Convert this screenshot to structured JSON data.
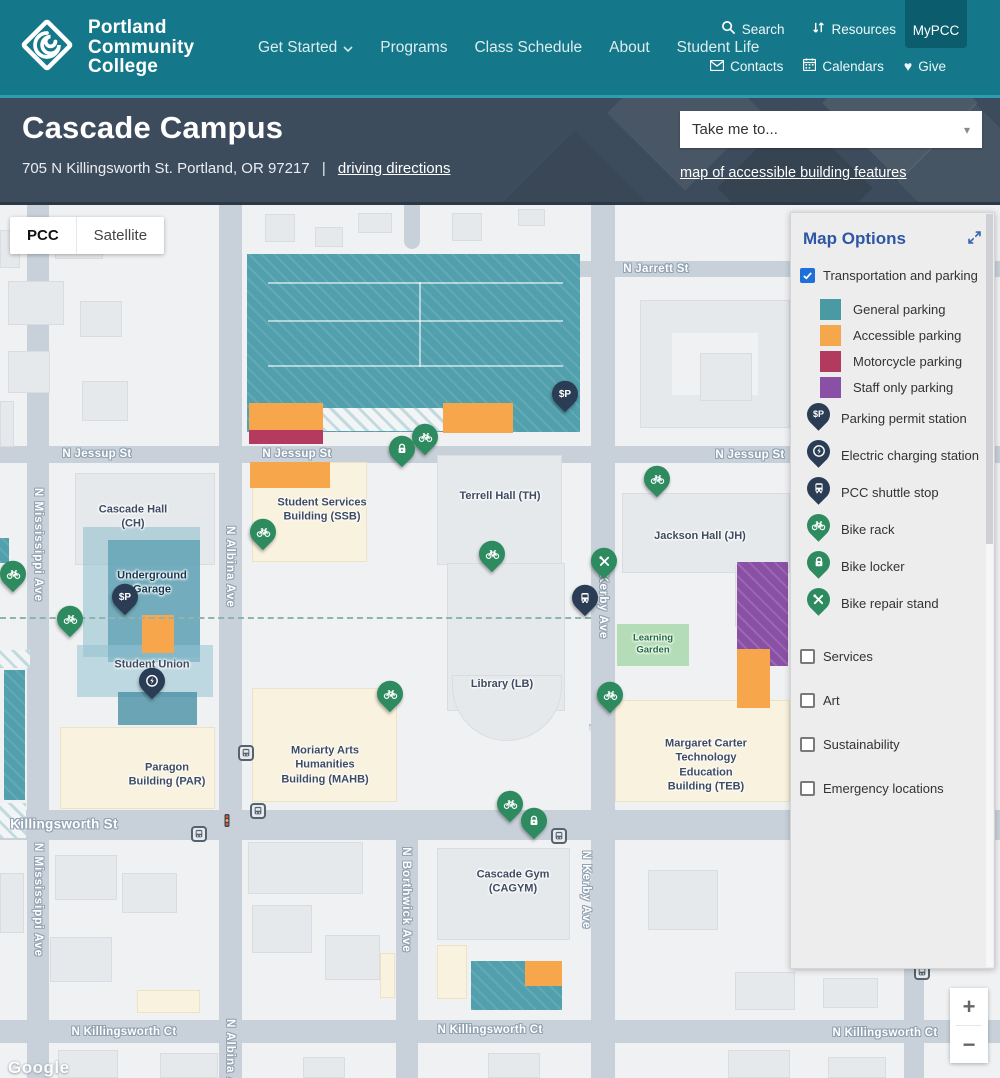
{
  "colors": {
    "header_teal": "#15788A",
    "header_teal_dark": "#0B5C6C",
    "subheader_dark": "#3D4C5C",
    "accent_blue": "#2D57A5",
    "checkbox_blue": "#1E6FD9",
    "pin_navy": "#2B3C55",
    "pin_green": "#2E8B5F",
    "street_gray": "#C8D1DA",
    "parking_teal": "#52A0AD",
    "parking_orange": "#F7A64B",
    "parking_magenta": "#B43A60",
    "parking_purple": "#8A50A5"
  },
  "header": {
    "logo": "Portland\nCommunity\nCollege",
    "nav": [
      {
        "label": "Get Started",
        "dropdown": true
      },
      {
        "label": "Programs"
      },
      {
        "label": "Class Schedule"
      },
      {
        "label": "About"
      },
      {
        "label": "Student Life"
      }
    ],
    "utility_top": [
      {
        "icon": "search",
        "label": "Search"
      },
      {
        "icon": "resources",
        "label": "Resources"
      }
    ],
    "mypcc": "MyPCC",
    "utility_bottom": [
      {
        "icon": "mail",
        "label": "Contacts"
      },
      {
        "icon": "calendar",
        "label": "Calendars"
      },
      {
        "icon": "heart",
        "label": "Give"
      }
    ]
  },
  "subheader": {
    "title": "Cascade Campus",
    "address": "705 N Killingsworth St. Portland, OR 97217",
    "separator": "|",
    "directions_link": "driving directions",
    "dropdown_placeholder": "Take me to...",
    "accessible_link": "map of accessible building features"
  },
  "panel": {
    "title": "Map Options",
    "sections": [
      {
        "type": "checkbox",
        "checked": true,
        "label": "Transportation and parking"
      },
      {
        "type": "swatch",
        "first": true,
        "color": "#4A9AA4",
        "label": "General parking"
      },
      {
        "type": "swatch",
        "color": "#F5A74B",
        "label": "Accessible parking"
      },
      {
        "type": "swatch",
        "color": "#B23A5E",
        "label": "Motorcycle parking"
      },
      {
        "type": "swatch",
        "color": "#8A50A5",
        "label": "Staff only parking"
      },
      {
        "type": "pin",
        "pin": "navy",
        "icon": "permit",
        "label": "Parking permit station"
      },
      {
        "type": "pin",
        "pin": "navy",
        "icon": "ev",
        "label": "Electric charging station"
      },
      {
        "type": "pin",
        "pin": "navy",
        "icon": "bus",
        "label": "PCC shuttle stop"
      },
      {
        "type": "pin",
        "pin": "green",
        "icon": "bike",
        "label": "Bike rack"
      },
      {
        "type": "pin",
        "pin": "green",
        "icon": "lock",
        "label": "Bike locker"
      },
      {
        "type": "pin",
        "pin": "green",
        "icon": "tools",
        "label": "Bike repair stand"
      },
      {
        "type": "checkbox",
        "checked": false,
        "spaced": true,
        "label": "Services"
      },
      {
        "type": "checkbox",
        "checked": false,
        "spaced": true,
        "label": "Art"
      },
      {
        "type": "checkbox",
        "checked": false,
        "spaced": true,
        "label": "Sustainability"
      },
      {
        "type": "checkbox",
        "checked": false,
        "spaced": true,
        "label": "Emergency locations"
      }
    ]
  },
  "map": {
    "controls": {
      "map_type": [
        "PCC",
        "Satellite"
      ],
      "zoom_in": "+",
      "zoom_out": "−"
    },
    "attribution": "Google",
    "elements": [
      {
        "n": "street-n-mississippi-ave",
        "c": "st",
        "x": 27,
        "y": 0,
        "w": 22,
        "h": 873
      },
      {
        "n": "street-n-albina-ave",
        "c": "st",
        "x": 219,
        "y": 0,
        "w": 23,
        "h": 873
      },
      {
        "n": "street-n-kerby-ave",
        "c": "st",
        "x": 591,
        "y": 0,
        "w": 24,
        "h": 873
      },
      {
        "n": "street-n-borthwick-ave",
        "c": "st",
        "x": 396,
        "y": 635,
        "w": 22,
        "h": 238
      },
      {
        "n": "street-stub",
        "c": "st rnd",
        "x": 404,
        "y": 0,
        "w": 16,
        "h": 44
      },
      {
        "n": "street-right",
        "c": "st",
        "x": 904,
        "y": 755,
        "w": 20,
        "h": 118
      },
      {
        "n": "street-n-jarrett-st",
        "c": "st",
        "x": 578,
        "y": 56,
        "w": 422,
        "h": 16
      },
      {
        "n": "street-n-jessup-st",
        "c": "st",
        "x": 0,
        "y": 241,
        "w": 1000,
        "h": 17
      },
      {
        "n": "street-n-killingsworth-st",
        "c": "st",
        "x": 0,
        "y": 605,
        "w": 1000,
        "h": 30
      },
      {
        "n": "street-n-killingsworth-ct",
        "c": "st",
        "x": 0,
        "y": 815,
        "w": 1000,
        "h": 23
      },
      {
        "c": "bld",
        "x": 0,
        "y": 25,
        "w": 20,
        "h": 38
      },
      {
        "c": "bld",
        "x": 55,
        "y": 18,
        "w": 48,
        "h": 36
      },
      {
        "c": "bld",
        "x": 8,
        "y": 76,
        "w": 56,
        "h": 44
      },
      {
        "c": "bld",
        "x": 80,
        "y": 96,
        "w": 42,
        "h": 36
      },
      {
        "c": "bld",
        "x": 8,
        "y": 146,
        "w": 42,
        "h": 42
      },
      {
        "c": "bld",
        "x": 82,
        "y": 176,
        "w": 46,
        "h": 40
      },
      {
        "c": "bld",
        "x": 0,
        "y": 196,
        "w": 14,
        "h": 46
      },
      {
        "c": "bld",
        "x": 265,
        "y": 9,
        "w": 30,
        "h": 28
      },
      {
        "c": "bld",
        "x": 315,
        "y": 22,
        "w": 28,
        "h": 20
      },
      {
        "c": "bld",
        "x": 358,
        "y": 8,
        "w": 34,
        "h": 20
      },
      {
        "c": "bld",
        "x": 452,
        "y": 8,
        "w": 30,
        "h": 28
      },
      {
        "c": "bld",
        "x": 518,
        "y": 4,
        "w": 27,
        "h": 17
      },
      {
        "n": "building-north-complex",
        "c": "bld",
        "x": 640,
        "y": 95,
        "w": 150,
        "h": 128
      },
      {
        "c": "cutout",
        "x": 672,
        "y": 128,
        "w": 86,
        "h": 62
      },
      {
        "c": "bld",
        "x": 700,
        "y": 148,
        "w": 52,
        "h": 48
      },
      {
        "n": "building-cascade-hall",
        "c": "bld",
        "x": 75,
        "y": 268,
        "w": 140,
        "h": 92
      },
      {
        "n": "building-ssb",
        "c": "bld cream",
        "x": 252,
        "y": 257,
        "w": 115,
        "h": 100
      },
      {
        "n": "building-terrell-hall",
        "c": "bld",
        "x": 437,
        "y": 250,
        "w": 125,
        "h": 110
      },
      {
        "n": "building-jackson-hall",
        "c": "bld",
        "x": 622,
        "y": 288,
        "w": 168,
        "h": 80
      },
      {
        "c": "bld",
        "x": 735,
        "y": 360,
        "w": 53,
        "h": 62
      },
      {
        "n": "building-library",
        "c": "bld",
        "x": 447,
        "y": 358,
        "w": 118,
        "h": 148
      },
      {
        "c": "bld arc",
        "x": 452,
        "y": 470,
        "w": 110,
        "h": 66
      },
      {
        "n": "building-mahb",
        "c": "bld cream",
        "x": 252,
        "y": 483,
        "w": 145,
        "h": 114
      },
      {
        "n": "building-teb",
        "c": "bld cream",
        "x": 615,
        "y": 495,
        "w": 175,
        "h": 102
      },
      {
        "n": "building-paragon",
        "c": "bld cream",
        "x": 60,
        "y": 522,
        "w": 155,
        "h": 82
      },
      {
        "c": "bld",
        "x": 248,
        "y": 637,
        "w": 115,
        "h": 52
      },
      {
        "n": "building-cascade-gym",
        "c": "bld",
        "x": 437,
        "y": 643,
        "w": 133,
        "h": 92
      },
      {
        "c": "bld cream",
        "x": 437,
        "y": 740,
        "w": 30,
        "h": 54
      },
      {
        "c": "bld cream",
        "x": 380,
        "y": 748,
        "w": 15,
        "h": 45
      },
      {
        "c": "bld cream",
        "x": 137,
        "y": 785,
        "w": 63,
        "h": 23
      },
      {
        "c": "bld",
        "x": 648,
        "y": 665,
        "w": 70,
        "h": 60
      },
      {
        "c": "bld",
        "x": 735,
        "y": 767,
        "w": 60,
        "h": 38
      },
      {
        "c": "bld",
        "x": 823,
        "y": 773,
        "w": 55,
        "h": 30
      },
      {
        "c": "bld",
        "x": 55,
        "y": 650,
        "w": 62,
        "h": 45
      },
      {
        "c": "bld",
        "x": 122,
        "y": 668,
        "w": 55,
        "h": 40
      },
      {
        "c": "bld",
        "x": 50,
        "y": 732,
        "w": 62,
        "h": 45
      },
      {
        "c": "bld",
        "x": 0,
        "y": 668,
        "w": 24,
        "h": 60
      },
      {
        "c": "bld",
        "x": 252,
        "y": 700,
        "w": 60,
        "h": 48
      },
      {
        "c": "bld",
        "x": 325,
        "y": 730,
        "w": 55,
        "h": 45
      },
      {
        "c": "bld",
        "x": 58,
        "y": 845,
        "w": 60,
        "h": 28
      },
      {
        "c": "bld",
        "x": 160,
        "y": 848,
        "w": 58,
        "h": 25
      },
      {
        "c": "bld",
        "x": 303,
        "y": 852,
        "w": 42,
        "h": 21
      },
      {
        "c": "bld",
        "x": 488,
        "y": 848,
        "w": 52,
        "h": 25
      },
      {
        "c": "bld",
        "x": 728,
        "y": 845,
        "w": 62,
        "h": 28
      },
      {
        "c": "bld",
        "x": 828,
        "y": 852,
        "w": 58,
        "h": 21
      },
      {
        "n": "parking-general-main",
        "c": "area teal",
        "x": 247,
        "y": 49,
        "w": 333,
        "h": 178
      },
      {
        "c": "lane",
        "x": 268,
        "y": 77,
        "w": 295,
        "h": 2
      },
      {
        "c": "lane",
        "x": 268,
        "y": 115,
        "w": 295,
        "h": 2
      },
      {
        "c": "lane",
        "x": 268,
        "y": 160,
        "w": 295,
        "h": 2
      },
      {
        "c": "lane",
        "x": 419,
        "y": 77,
        "w": 2,
        "h": 85
      },
      {
        "n": "parking-accessible-1",
        "c": "area orange",
        "x": 249,
        "y": 198,
        "w": 74,
        "h": 28
      },
      {
        "n": "parking-motorcycle",
        "c": "area magenta",
        "x": 249,
        "y": 225,
        "w": 74,
        "h": 14
      },
      {
        "c": "area drive",
        "x": 323,
        "y": 203,
        "w": 120,
        "h": 23
      },
      {
        "n": "parking-accessible-2",
        "c": "area orange",
        "x": 443,
        "y": 198,
        "w": 70,
        "h": 30
      },
      {
        "n": "parking-accessible-3",
        "c": "area orange",
        "x": 250,
        "y": 257,
        "w": 80,
        "h": 26
      },
      {
        "n": "parking-staff-only",
        "c": "area purple",
        "x": 737,
        "y": 357,
        "w": 51,
        "h": 104
      },
      {
        "n": "parking-accessible-4",
        "c": "area orange",
        "x": 737,
        "y": 444,
        "w": 33,
        "h": 59
      },
      {
        "n": "parking-general-south",
        "c": "area teal",
        "x": 471,
        "y": 756,
        "w": 91,
        "h": 49
      },
      {
        "n": "parking-accessible-5",
        "c": "area orange",
        "x": 525,
        "y": 756,
        "w": 37,
        "h": 25
      },
      {
        "c": "area teal",
        "x": 4,
        "y": 465,
        "w": 21,
        "h": 130
      },
      {
        "c": "area teal",
        "x": 0,
        "y": 333,
        "w": 9,
        "h": 25
      },
      {
        "c": "area drive",
        "x": 0,
        "y": 445,
        "w": 30,
        "h": 18
      },
      {
        "c": "area drive",
        "x": 0,
        "y": 598,
        "w": 26,
        "h": 35
      },
      {
        "n": "underground-garage-area",
        "c": "ov",
        "x": 83,
        "y": 322,
        "w": 117,
        "h": 130,
        "bg": "rgba(130,185,200,0.5)"
      },
      {
        "c": "ov",
        "x": 108,
        "y": 335,
        "w": 92,
        "h": 122,
        "bg": "rgba(86,156,176,0.72)"
      },
      {
        "c": "ov",
        "x": 77,
        "y": 440,
        "w": 136,
        "h": 52,
        "bg": "rgba(150,195,210,0.55)"
      },
      {
        "c": "ov",
        "x": 118,
        "y": 487,
        "w": 79,
        "h": 33,
        "bg": "rgba(72,145,165,0.8)"
      },
      {
        "n": "parking-accessible-6",
        "c": "area orange",
        "x": 142,
        "y": 410,
        "w": 32,
        "h": 38
      },
      {
        "n": "learning-garden-area",
        "c": "area garden",
        "x": 617,
        "y": 419,
        "w": 72,
        "h": 42
      },
      {
        "n": "campus-boundary-dashed",
        "c": "dashline",
        "x": 0,
        "y": 412,
        "w": 591,
        "h": 0
      },
      {
        "n": "street-label",
        "c": "slbl",
        "x": 97,
        "y": 249,
        "t": "N Jessup St"
      },
      {
        "n": "street-label",
        "c": "slbl",
        "x": 297,
        "y": 249,
        "t": "N Jessup St"
      },
      {
        "n": "street-label",
        "c": "slbl",
        "x": 750,
        "y": 250,
        "t": "N Jessup St"
      },
      {
        "n": "street-label",
        "c": "slbl",
        "x": 656,
        "y": 64,
        "t": "N Jarrett St"
      },
      {
        "n": "street-label",
        "c": "slbl big",
        "x": 64,
        "y": 619,
        "t": "Killingsworth St"
      },
      {
        "n": "street-label",
        "c": "slbl",
        "x": 124,
        "y": 827,
        "t": "N Killingsworth Ct"
      },
      {
        "n": "street-label",
        "c": "slbl",
        "x": 490,
        "y": 825,
        "t": "N Killingsworth Ct"
      },
      {
        "n": "street-label",
        "c": "slbl",
        "x": 885,
        "y": 828,
        "t": "N Killingsworth Ct"
      },
      {
        "n": "street-label",
        "c": "slbl",
        "x": -55,
        "y": 827,
        "t": "N Killingsworth Ct"
      },
      {
        "n": "street-label",
        "c": "slbl vert",
        "x": 38,
        "y": 340,
        "t": "N Mississippi Ave"
      },
      {
        "n": "street-label",
        "c": "slbl vert",
        "x": 38,
        "y": 695,
        "t": "N Mississippi Ave"
      },
      {
        "n": "street-label",
        "c": "slbl vert",
        "x": 230,
        "y": 362,
        "t": "N Albina Ave"
      },
      {
        "n": "street-label",
        "c": "slbl vert",
        "x": 230,
        "y": 855,
        "t": "N Albina Ave"
      },
      {
        "n": "street-label",
        "c": "slbl vert",
        "x": 603,
        "y": 395,
        "t": "N Kerby Ave"
      },
      {
        "n": "street-label",
        "c": "slbl vert",
        "x": 586,
        "y": 685,
        "t": "N Kerby Ave"
      },
      {
        "n": "street-label",
        "c": "slbl vert",
        "x": 406,
        "y": 695,
        "t": "N Borthwick Ave"
      },
      {
        "n": "building-label-cascade-hall",
        "c": "lbl",
        "x": 133,
        "y": 312,
        "t": "Cascade Hall\n(CH)"
      },
      {
        "n": "building-label-underground-garage",
        "c": "lbl navy",
        "x": 152,
        "y": 378,
        "t": "Underground\nGarage"
      },
      {
        "n": "building-label-student-union",
        "c": "lbl",
        "x": 152,
        "y": 467,
        "t": "Student Union\n(SU)"
      },
      {
        "n": "building-label-ssb",
        "c": "lbl",
        "x": 322,
        "y": 305,
        "t": "Student Services\nBuilding (SSB)"
      },
      {
        "n": "building-label-terrell-hall",
        "c": "lbl",
        "x": 500,
        "y": 291,
        "t": "Terrell Hall (TH)"
      },
      {
        "n": "building-label-jackson-hall",
        "c": "lbl",
        "x": 700,
        "y": 331,
        "t": "Jackson Hall (JH)"
      },
      {
        "n": "building-label-library",
        "c": "lbl",
        "x": 502,
        "y": 479,
        "t": "Library (LB)"
      },
      {
        "n": "learning-garden-label",
        "c": "lbl green",
        "x": 653,
        "y": 440,
        "t": "Learning\nGarden"
      },
      {
        "n": "building-label-mahb",
        "c": "lbl",
        "x": 325,
        "y": 560,
        "t": "Moriarty Arts\nHumanities\nBuilding (MAHB)"
      },
      {
        "n": "building-label-teb",
        "c": "lbl",
        "x": 706,
        "y": 560,
        "t": "Margaret Carter\nTechnology\nEducation\nBuilding (TEB)"
      },
      {
        "n": "building-label-paragon",
        "c": "lbl",
        "x": 167,
        "y": 570,
        "t": "Paragon\nBuilding (PAR)"
      },
      {
        "n": "building-label-cascade-gym",
        "c": "lbl",
        "x": 513,
        "y": 677,
        "t": "Cascade Gym\n(CAGYM)"
      },
      {
        "c": "transit",
        "x": 246,
        "y": 548
      },
      {
        "c": "transit",
        "x": 258,
        "y": 606
      },
      {
        "c": "transit",
        "x": 199,
        "y": 629
      },
      {
        "c": "transit",
        "x": 559,
        "y": 631
      },
      {
        "c": "transit",
        "x": 922,
        "y": 767
      },
      {
        "c": "tlight",
        "x": 227,
        "y": 618
      },
      {
        "c": "uparrow",
        "x": 590,
        "y": 522,
        "t": "↑"
      },
      {
        "c": "pin navy",
        "i": "permit",
        "x": 565,
        "y": 199
      },
      {
        "c": "pin navy",
        "i": "permit",
        "x": 125,
        "y": 402
      },
      {
        "c": "pin navy",
        "i": "ev",
        "x": 152,
        "y": 486
      },
      {
        "c": "pin navy",
        "i": "bus",
        "x": 585,
        "y": 403
      },
      {
        "c": "pin green",
        "i": "bike",
        "x": 425,
        "y": 242
      },
      {
        "c": "pin green",
        "i": "lock",
        "x": 402,
        "y": 254
      },
      {
        "c": "pin green",
        "i": "bike",
        "x": 263,
        "y": 337
      },
      {
        "c": "pin green",
        "i": "bike",
        "x": 13,
        "y": 379
      },
      {
        "c": "pin green",
        "i": "bike",
        "x": 70,
        "y": 424
      },
      {
        "c": "pin green",
        "i": "bike",
        "x": 492,
        "y": 359
      },
      {
        "c": "pin green",
        "i": "bike",
        "x": 657,
        "y": 284
      },
      {
        "c": "pin green",
        "i": "tools",
        "x": 604,
        "y": 366
      },
      {
        "c": "pin green",
        "i": "bike",
        "x": 610,
        "y": 500
      },
      {
        "c": "pin green",
        "i": "bike",
        "x": 390,
        "y": 499
      },
      {
        "c": "pin green",
        "i": "bike",
        "x": 510,
        "y": 609
      },
      {
        "c": "pin green",
        "i": "lock",
        "x": 534,
        "y": 626
      }
    ]
  }
}
